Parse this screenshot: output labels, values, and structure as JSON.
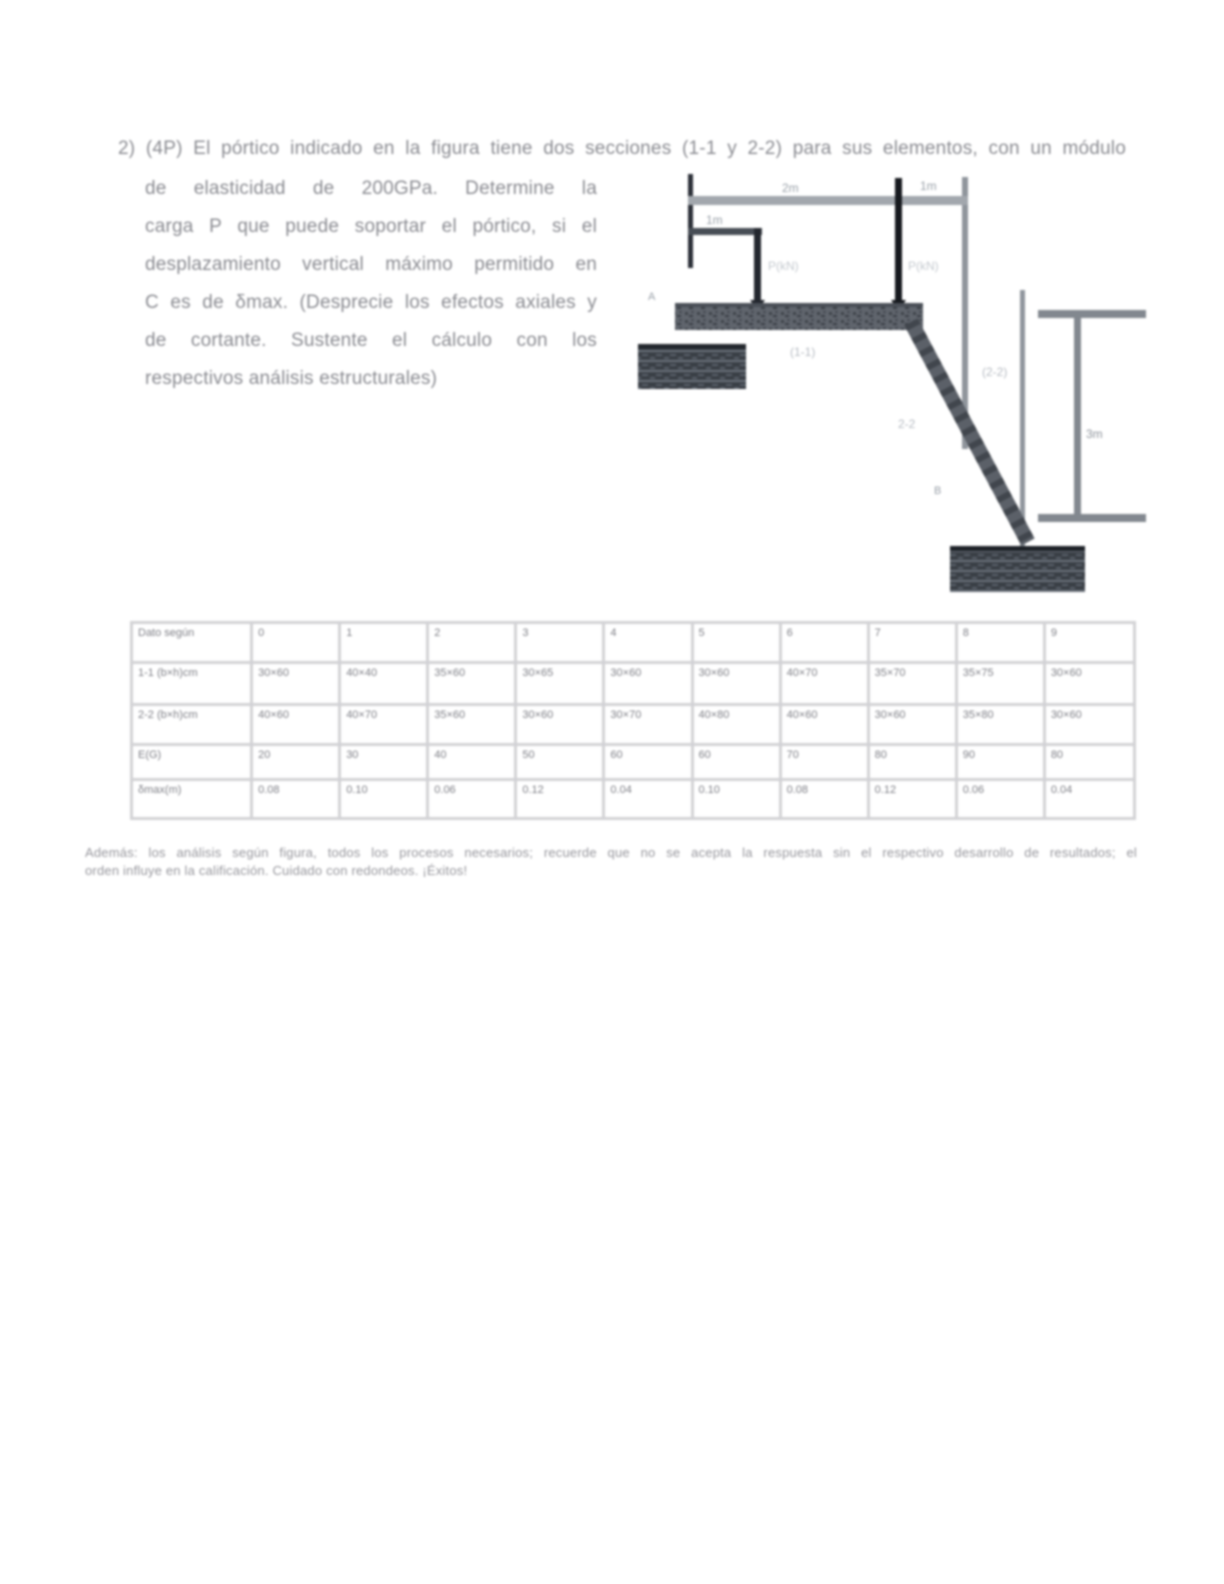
{
  "problem": {
    "line1": "2)  (4P) El pórtico indicado en la figura tiene dos secciones (1-1 y 2-2) para sus elementos, con un módulo",
    "body_lines": [
      "de elasticidad de 200GPa. Determine la",
      "carga P que puede soportar el pórtico, si el",
      "desplazamiento vertical máximo permitido en",
      "C es de δmax. (Desprecie los efectos axiales y",
      "de cortante. Sustente el cálculo con los",
      "respectivos análisis estructurales)"
    ]
  },
  "figure": {
    "labels": {
      "dim_top_left": "2m",
      "dim_top_right": "1m",
      "dim_left": "1m",
      "load_left": "P(kN)",
      "load_right": "P(kN)",
      "node_a": "A",
      "node_b": "B",
      "section_beam": "(1-1)",
      "section_diag": "2-2",
      "section_diag_alt": "(2-2)",
      "dim_right": "3m"
    },
    "colors": {
      "beam": "#60656d",
      "support": "#3a3f46",
      "dimension": "#9aa0a6",
      "arrow": "#16191e",
      "label": "#b6bbc2"
    }
  },
  "table": {
    "header": [
      "Dato según",
      "0",
      "1",
      "2",
      "3",
      "4",
      "5",
      "6",
      "7",
      "8",
      "9"
    ],
    "rows": [
      {
        "label": "1-1 (b×h)cm",
        "values": [
          "30×60",
          "40×40",
          "35×60",
          "30×65",
          "30×60",
          "30×60",
          "40×70",
          "35×70",
          "35×75",
          "30×60"
        ]
      },
      {
        "label": "2-2 (b×h)cm",
        "values": [
          "40×60",
          "40×70",
          "35×60",
          "30×60",
          "30×70",
          "40×80",
          "40×60",
          "30×60",
          "35×80",
          "30×60"
        ]
      },
      {
        "label": "E(G)",
        "values": [
          "20",
          "30",
          "40",
          "50",
          "60",
          "60",
          "70",
          "80",
          "90",
          "80"
        ]
      },
      {
        "label": "δmax(m)",
        "values": [
          "0.08",
          "0.10",
          "0.06",
          "0.12",
          "0.04",
          "0.10",
          "0.08",
          "0.12",
          "0.06",
          "0.04"
        ]
      }
    ]
  },
  "footnote": {
    "lines": [
      "Además: los análisis según figura, todos los procesos necesarios; recuerde que no se acepta la respuesta sin el respectivo desarrollo de resultados; el",
      "orden influye en la calificación. Cuidado con redondeos. ¡Éxitos!"
    ]
  }
}
